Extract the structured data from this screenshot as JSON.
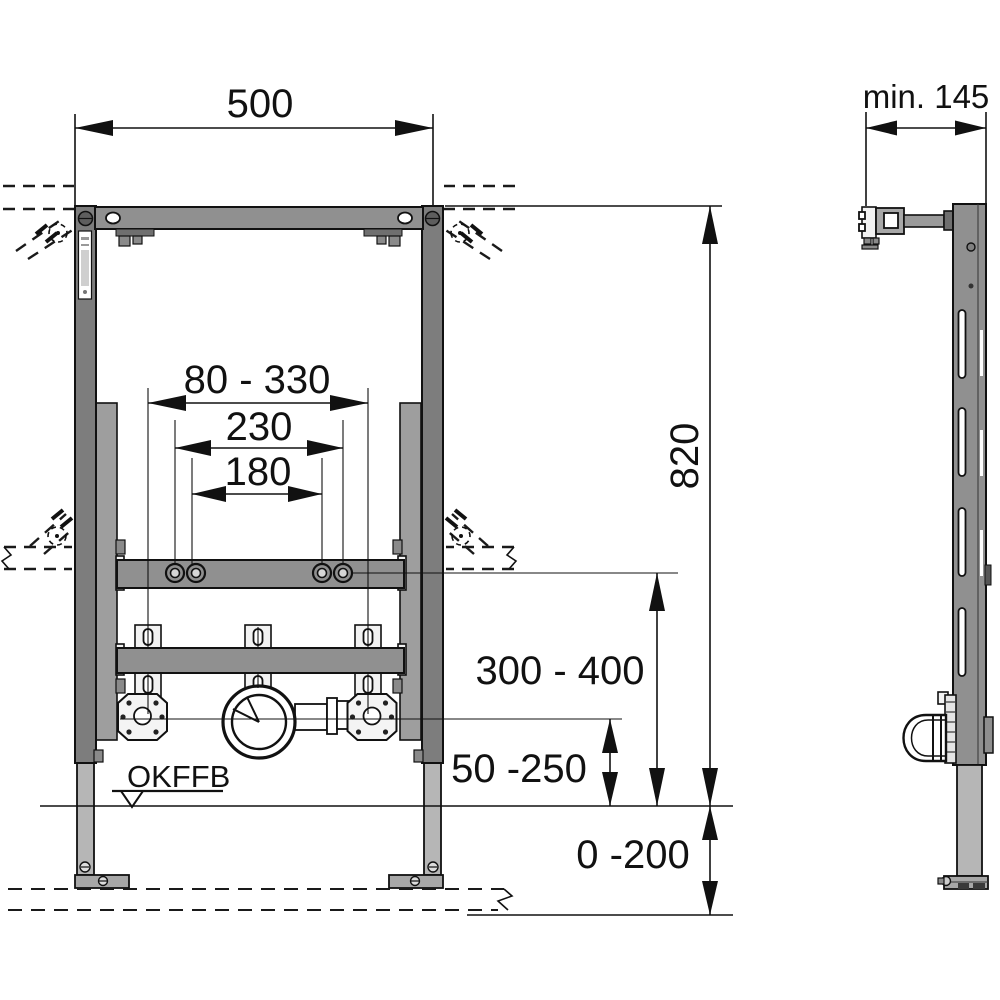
{
  "front_view": {
    "dims": {
      "frame_width": "500",
      "anchor_range": "80 - 330",
      "spacing_outer": "230",
      "spacing_inner": "180",
      "frame_height": "820",
      "rail_height_range": "300 - 400",
      "drain_height_range": "50 -250",
      "floor_buildup_range": "0 -200"
    },
    "floor_level_label": "OKFFB"
  },
  "side_view": {
    "dims": {
      "min_depth": "min. 145"
    }
  }
}
